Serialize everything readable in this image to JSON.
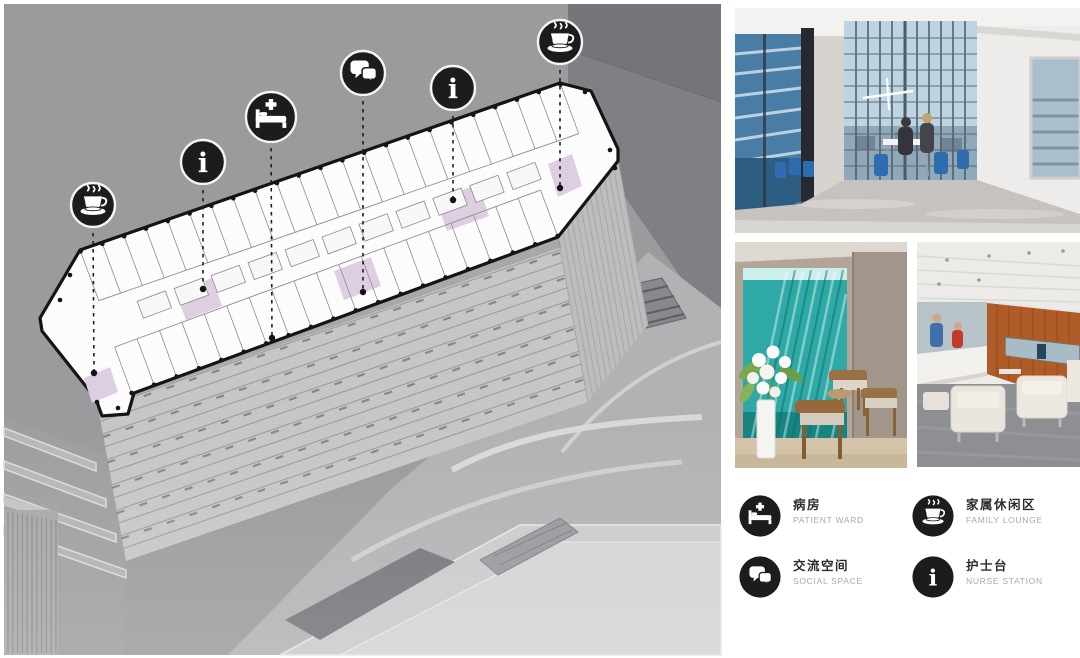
{
  "colors": {
    "icon_bg": "#1c1c1e",
    "plan_accent": "#ddcfe1",
    "bg_gray": "#9b9b9d",
    "teal_glass": "#2fa9a6",
    "wood_wall": "#b05c28",
    "chair_blue": "#2e6cb0"
  },
  "legend": {
    "items": [
      {
        "id": "patient-ward",
        "icon": "icon-bed",
        "zh": "病房",
        "en": "PATIENT WARD"
      },
      {
        "id": "family-lounge",
        "icon": "icon-coffee",
        "zh": "家属休闲区",
        "en": "FAMILY LOUNGE"
      },
      {
        "id": "social-space",
        "icon": "icon-speech",
        "zh": "交流空间",
        "en": "SOCIAL SPACE"
      },
      {
        "id": "nurse-station",
        "icon": "icon-info",
        "zh": "护士台",
        "en": "NURSE STATION"
      }
    ]
  },
  "diagram": {
    "callouts": [
      {
        "icon": "icon-coffee",
        "legend": "family-lounge",
        "x": 93,
        "y": 205,
        "r": 22,
        "tx": 94,
        "ty": 373
      },
      {
        "icon": "icon-info",
        "legend": "nurse-station",
        "x": 203,
        "y": 162,
        "r": 22,
        "tx": 203,
        "ty": 289
      },
      {
        "icon": "icon-bed",
        "legend": "patient-ward",
        "x": 271,
        "y": 117,
        "r": 25,
        "tx": 272,
        "ty": 338
      },
      {
        "icon": "icon-speech",
        "legend": "social-space",
        "x": 363,
        "y": 73,
        "r": 22,
        "tx": 363,
        "ty": 292
      },
      {
        "icon": "icon-info",
        "legend": "nurse-station",
        "x": 453,
        "y": 88,
        "r": 22,
        "tx": 453,
        "ty": 200
      },
      {
        "icon": "icon-coffee",
        "legend": "family-lounge",
        "x": 560,
        "y": 42,
        "r": 22,
        "tx": 560,
        "ty": 188
      }
    ]
  },
  "photos": {
    "lounge": {
      "alt": "Double-height family lounge with glazed curtain wall, city view and blue chairs"
    },
    "glass_nook": {
      "alt": "Seating nook with teal art-glass wall, white flowers and wooden chairs"
    },
    "nurse_lounge": {
      "alt": "Waiting lounge with wood-panelled wall, nurse station and white armchairs"
    }
  }
}
